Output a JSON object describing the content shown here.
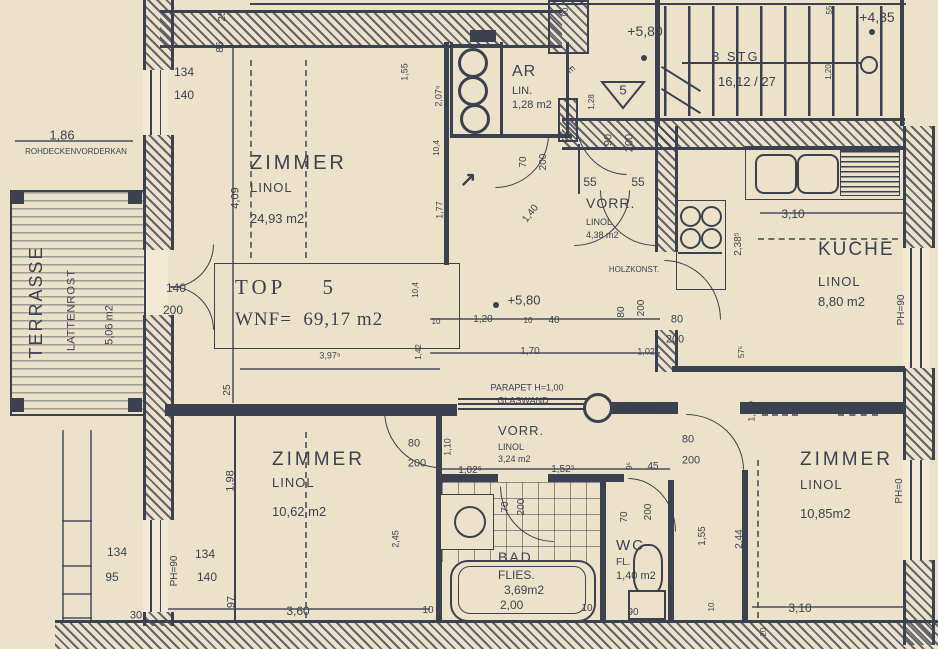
{
  "meta": {
    "paper_color": "#ece2c9",
    "ink_color": "#3c4150",
    "drawing_type": "apartment floor plan"
  },
  "unit_box": {
    "line1": "TOP    5",
    "line2": "WNF=  69,17 m2"
  },
  "entrance_marker": "5",
  "icons": {
    "entry_arrow": "↗"
  },
  "rooms": {
    "zimmer_nw": {
      "name": "ZIMMER",
      "floor": "LINOL",
      "area": "24,93 m2"
    },
    "zimmer_sw": {
      "name": "ZIMMER",
      "floor": "LINOL",
      "area": "10,62 m2"
    },
    "zimmer_se": {
      "name": "ZIMMER",
      "floor": "LINOL",
      "area": "10,85m2"
    },
    "kueche": {
      "name": "KUCHE",
      "floor": "LINOL",
      "area": "8,80 m2"
    },
    "vorr_upper": {
      "name": "VORR.",
      "floor": "LINOL",
      "area": "4,38 m2"
    },
    "vorr_lower": {
      "name": "VORR.",
      "floor": "LINOL",
      "area": "3,24 m2"
    },
    "ar": {
      "name": "AR",
      "floor": "LIN.",
      "area": "1,28 m2"
    },
    "bad": {
      "name": "BAD",
      "floor": "FLIES.",
      "area": "3,69m2",
      "extra": "2,00"
    },
    "wc": {
      "name": "WC",
      "floor": "FL.",
      "area": "1,40 m2"
    },
    "terrasse": {
      "name": "TERRASSE",
      "floor": "LATTENROST",
      "area": "5,06 m2"
    },
    "stairs": {
      "line1": "8 STG",
      "line2": "16,12 / 27"
    }
  },
  "annotations": [
    {
      "t": "1,86",
      "x": 62,
      "y": 135,
      "fs": 13
    },
    {
      "t": "ROHDECKENVORDERKAN",
      "x": 76,
      "y": 152,
      "fs": 8
    },
    {
      "t": "134",
      "x": 184,
      "y": 72,
      "fs": 12
    },
    {
      "t": "140",
      "x": 184,
      "y": 95,
      "fs": 12
    },
    {
      "t": "25",
      "x": 223,
      "y": 16,
      "r": -90,
      "fs": 10
    },
    {
      "t": "86",
      "x": 221,
      "y": 47,
      "r": -90,
      "fs": 10
    },
    {
      "t": "4,09",
      "x": 236,
      "y": 198,
      "r": -90,
      "fs": 11
    },
    {
      "t": "140",
      "x": 176,
      "y": 288,
      "fs": 12
    },
    {
      "t": "200",
      "x": 173,
      "y": 310,
      "fs": 12
    },
    {
      "t": "1,55",
      "x": 405,
      "y": 72,
      "r": -90,
      "fs": 9
    },
    {
      "t": "2,07⁵",
      "x": 439,
      "y": 96,
      "r": -90,
      "fs": 9
    },
    {
      "t": "10,4",
      "x": 437,
      "y": 148,
      "r": -90,
      "fs": 8
    },
    {
      "t": "1,77",
      "x": 440,
      "y": 210,
      "r": -90,
      "fs": 9
    },
    {
      "t": "10,4",
      "x": 416,
      "y": 290,
      "r": -90,
      "fs": 8
    },
    {
      "t": "1,42",
      "x": 419,
      "y": 352,
      "r": -90,
      "fs": 8
    },
    {
      "t": "3,97⁵",
      "x": 330,
      "y": 356,
      "fs": 9
    },
    {
      "t": "25",
      "x": 228,
      "y": 390,
      "r": -90,
      "fs": 10
    },
    {
      "t": "90",
      "x": 566,
      "y": 12,
      "r": -90,
      "fs": 8
    },
    {
      "t": "E",
      "x": 571,
      "y": 70,
      "r": 52,
      "fs": 9
    },
    {
      "t": "+5,80",
      "x": 645,
      "y": 31,
      "fs": 14
    },
    {
      "t": "+4,35",
      "x": 877,
      "y": 17,
      "fs": 14
    },
    {
      "t": "55",
      "x": 830,
      "y": 10,
      "r": -90,
      "fs": 8
    },
    {
      "t": "1,20",
      "x": 829,
      "y": 72,
      "r": -90,
      "fs": 8
    },
    {
      "t": "90",
      "x": 609,
      "y": 140,
      "r": -90,
      "fs": 11
    },
    {
      "t": "200",
      "x": 630,
      "y": 143,
      "r": -90,
      "fs": 11
    },
    {
      "t": "55",
      "x": 590,
      "y": 182,
      "fs": 12
    },
    {
      "t": "55",
      "x": 638,
      "y": 182,
      "fs": 12
    },
    {
      "t": "1,28",
      "x": 592,
      "y": 102,
      "r": -90,
      "fs": 8
    },
    {
      "t": "1,40",
      "x": 531,
      "y": 214,
      "r": -52,
      "fs": 10
    },
    {
      "t": "70",
      "x": 524,
      "y": 162,
      "r": -90,
      "fs": 10
    },
    {
      "t": "200",
      "x": 544,
      "y": 162,
      "r": -90,
      "fs": 10
    },
    {
      "t": "HOLZKONST.",
      "x": 634,
      "y": 270,
      "fs": 8
    },
    {
      "t": "+5,80",
      "x": 524,
      "y": 300,
      "fs": 13
    },
    {
      "t": "3,10",
      "x": 793,
      "y": 214,
      "fs": 12
    },
    {
      "t": "2,38⁵",
      "x": 739,
      "y": 244,
      "r": -90,
      "fs": 10
    },
    {
      "t": "PH=90",
      "x": 902,
      "y": 310,
      "r": -90,
      "fs": 10
    },
    {
      "t": "80",
      "x": 677,
      "y": 320,
      "fs": 11
    },
    {
      "t": "200",
      "x": 675,
      "y": 340,
      "fs": 11
    },
    {
      "t": "10",
      "x": 436,
      "y": 322,
      "fs": 8
    },
    {
      "t": "1,20",
      "x": 483,
      "y": 320,
      "fs": 10
    },
    {
      "t": "10",
      "x": 528,
      "y": 321,
      "fs": 8
    },
    {
      "t": "40",
      "x": 554,
      "y": 321,
      "fs": 10
    },
    {
      "t": "80",
      "x": 622,
      "y": 312,
      "r": -90,
      "fs": 10
    },
    {
      "t": "200",
      "x": 642,
      "y": 308,
      "r": -90,
      "fs": 10
    },
    {
      "t": "1,70",
      "x": 530,
      "y": 352,
      "fs": 10
    },
    {
      "t": "1,02⁵",
      "x": 648,
      "y": 352,
      "fs": 9
    },
    {
      "t": "57⁵",
      "x": 742,
      "y": 352,
      "r": -90,
      "fs": 8
    },
    {
      "t": "PARAPET H=1,00",
      "x": 527,
      "y": 388,
      "fs": 9
    },
    {
      "t": "GLASWAND",
      "x": 523,
      "y": 401,
      "fs": 9
    },
    {
      "t": "HOLZKONST.",
      "x": 640,
      "y": 407,
      "fs": 8
    },
    {
      "t": "80",
      "x": 414,
      "y": 444,
      "fs": 11
    },
    {
      "t": "200",
      "x": 417,
      "y": 464,
      "fs": 11
    },
    {
      "t": "1,10",
      "x": 448,
      "y": 447,
      "r": -90,
      "fs": 9
    },
    {
      "t": "80",
      "x": 688,
      "y": 440,
      "fs": 11
    },
    {
      "t": "200",
      "x": 691,
      "y": 461,
      "fs": 11
    },
    {
      "t": "1,05⁵",
      "x": 752,
      "y": 411,
      "r": -90,
      "fs": 9
    },
    {
      "t": "1,98",
      "x": 231,
      "y": 481,
      "r": -90,
      "fs": 11
    },
    {
      "t": "2,45",
      "x": 396,
      "y": 539,
      "r": -90,
      "fs": 9
    },
    {
      "t": "1,02⁵",
      "x": 470,
      "y": 471,
      "fs": 10
    },
    {
      "t": "1,52⁵",
      "x": 563,
      "y": 470,
      "fs": 10
    },
    {
      "t": "9⁵",
      "x": 630,
      "y": 466,
      "r": -90,
      "fs": 8
    },
    {
      "t": "45",
      "x": 653,
      "y": 467,
      "fs": 10
    },
    {
      "t": "70",
      "x": 506,
      "y": 507,
      "r": -90,
      "fs": 10
    },
    {
      "t": "200",
      "x": 522,
      "y": 507,
      "r": -90,
      "fs": 10
    },
    {
      "t": "70",
      "x": 625,
      "y": 517,
      "r": -90,
      "fs": 10
    },
    {
      "t": "200",
      "x": 649,
      "y": 512,
      "r": -90,
      "fs": 10
    },
    {
      "t": "1,55",
      "x": 703,
      "y": 536,
      "r": -90,
      "fs": 10
    },
    {
      "t": "2,44",
      "x": 740,
      "y": 539,
      "r": -90,
      "fs": 10
    },
    {
      "t": "PH=0",
      "x": 900,
      "y": 491,
      "r": -90,
      "fs": 10
    },
    {
      "t": "134",
      "x": 117,
      "y": 552,
      "fs": 12
    },
    {
      "t": "95",
      "x": 112,
      "y": 577,
      "fs": 12
    },
    {
      "t": "PH=90",
      "x": 175,
      "y": 571,
      "r": -90,
      "fs": 10
    },
    {
      "t": "134",
      "x": 205,
      "y": 554,
      "fs": 12
    },
    {
      "t": "140",
      "x": 207,
      "y": 577,
      "fs": 12
    },
    {
      "t": "97",
      "x": 232,
      "y": 602,
      "r": -90,
      "fs": 11
    },
    {
      "t": "30",
      "x": 136,
      "y": 616,
      "fs": 11
    },
    {
      "t": "3,60",
      "x": 298,
      "y": 611,
      "fs": 12
    },
    {
      "t": "10",
      "x": 428,
      "y": 611,
      "fs": 10
    },
    {
      "t": "10",
      "x": 587,
      "y": 609,
      "fs": 10
    },
    {
      "t": "90",
      "x": 633,
      "y": 613,
      "fs": 10
    },
    {
      "t": "10",
      "x": 712,
      "y": 607,
      "r": -90,
      "fs": 8
    },
    {
      "t": "20",
      "x": 764,
      "y": 632,
      "r": -90,
      "fs": 8
    },
    {
      "t": "3,10",
      "x": 800,
      "y": 608,
      "fs": 12
    }
  ]
}
